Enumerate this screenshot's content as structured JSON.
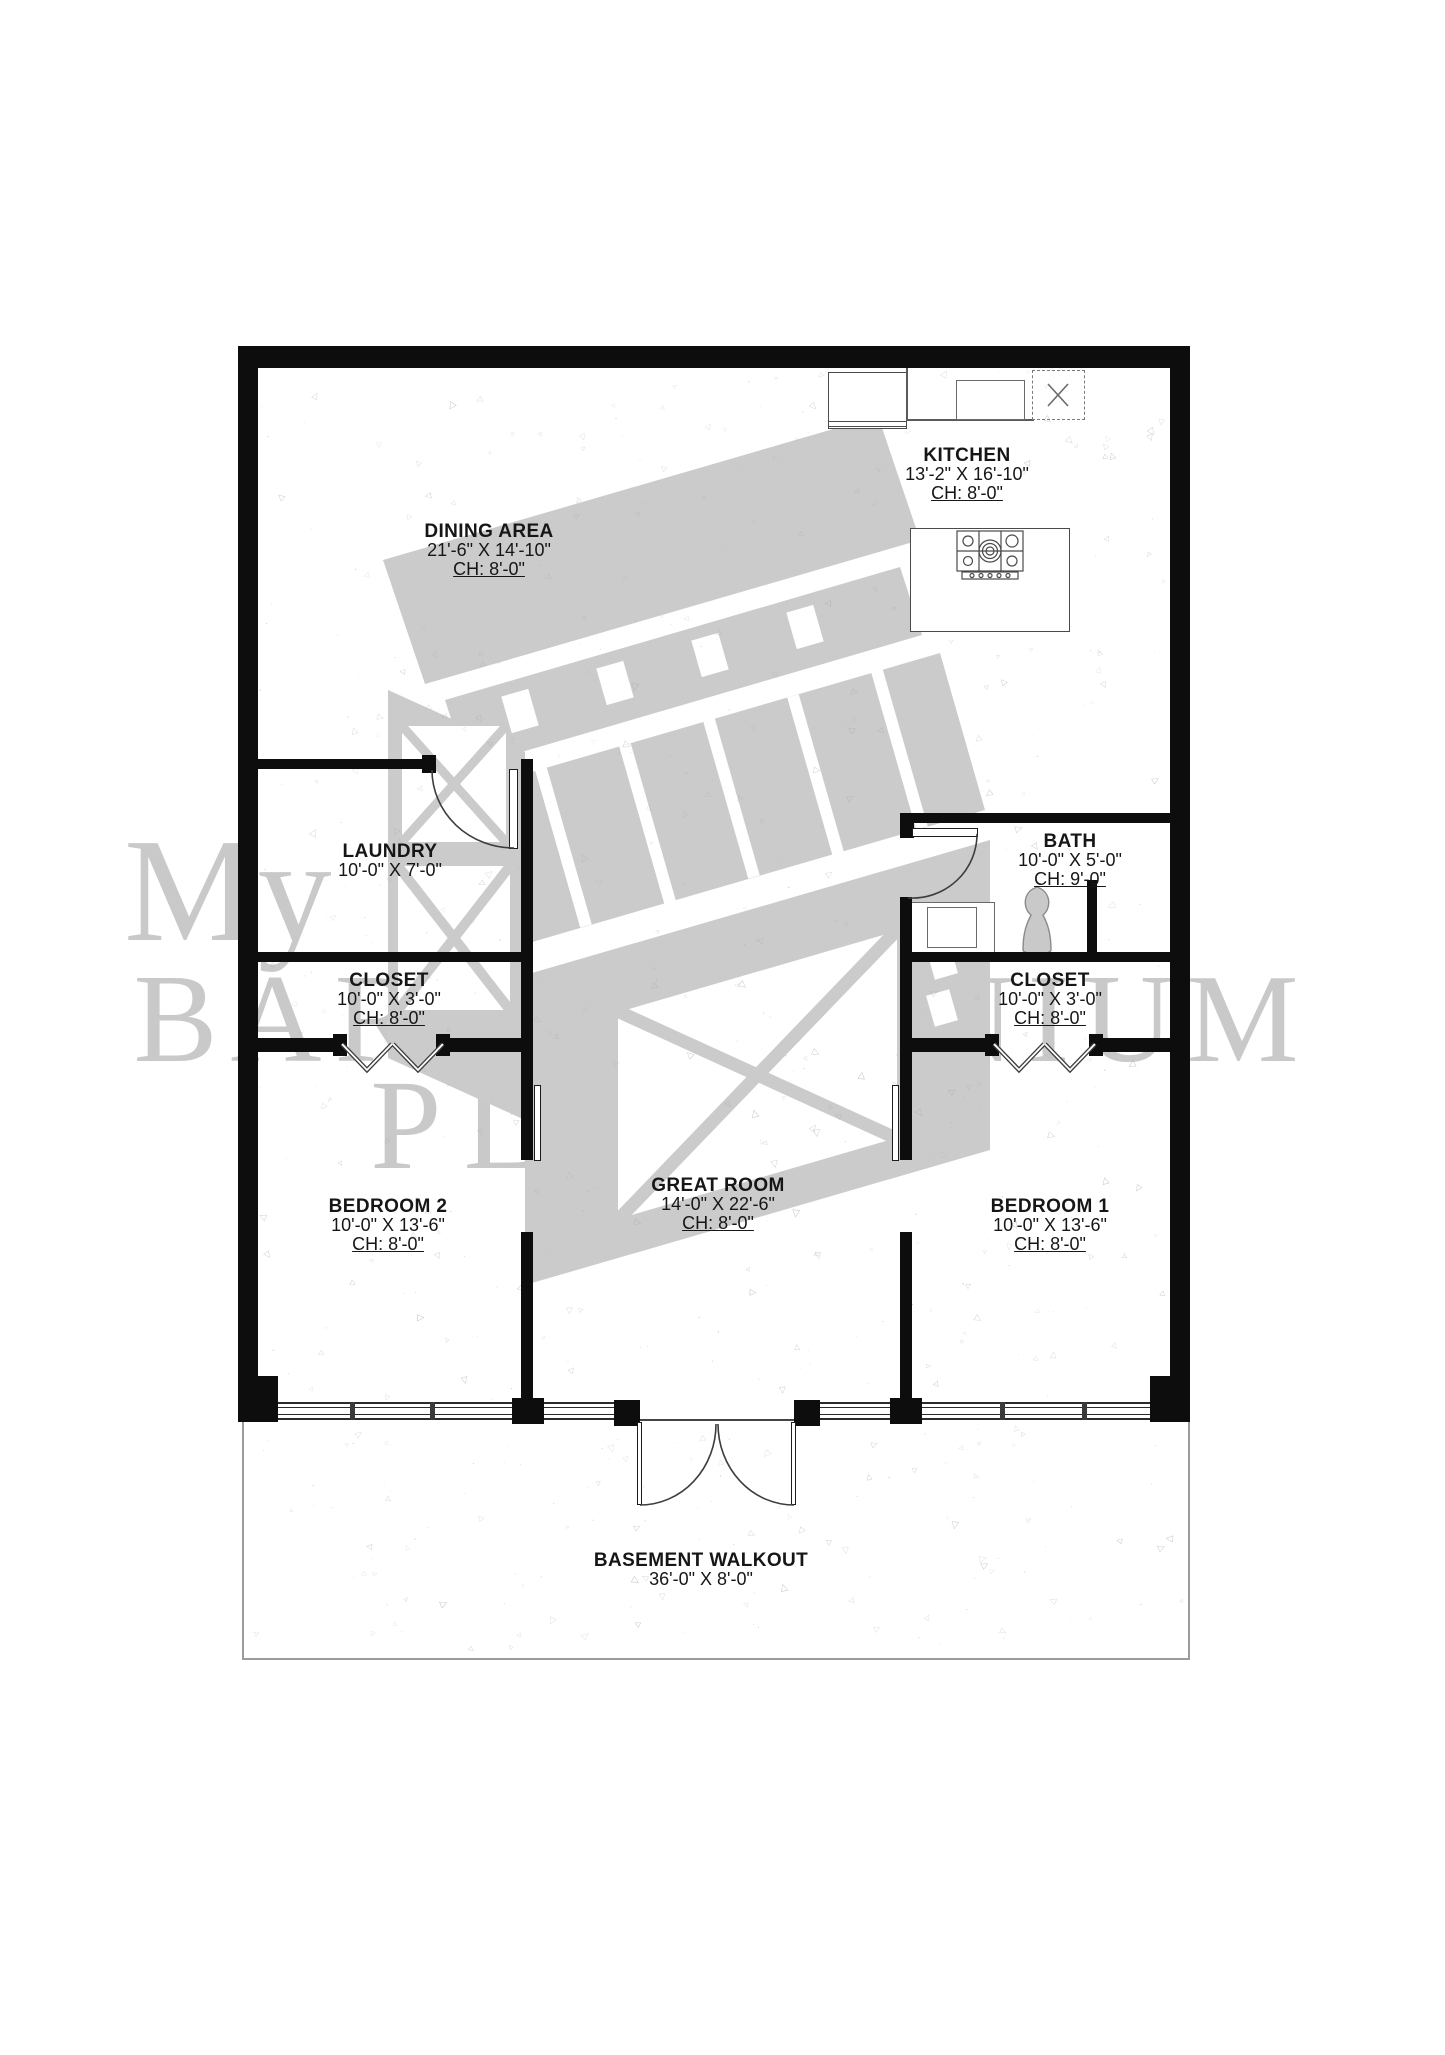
{
  "watermark": {
    "line1": "My",
    "line2": "BARNDOMINIUM",
    "line3": "PLANS",
    "color": "#c9c9c9"
  },
  "rooms": {
    "kitchen": {
      "name": "KITCHEN",
      "dims": "13'-2\" X 16'-10\"",
      "ceiling": "CH: 8'-0\""
    },
    "dining": {
      "name": "DINING AREA",
      "dims": "21'-6\" X 14'-10\"",
      "ceiling": "CH: 8'-0\""
    },
    "laundry": {
      "name": "LAUNDRY",
      "dims": "10'-0\" X 7'-0\""
    },
    "bath": {
      "name": "BATH",
      "dims": "10'-0\" X 5'-0\"",
      "ceiling": "CH: 9'-0\""
    },
    "closet_left": {
      "name": "CLOSET",
      "dims": "10'-0\" X 3'-0\"",
      "ceiling": "CH: 8'-0\""
    },
    "closet_right": {
      "name": "CLOSET",
      "dims": "10'-0\" X 3'-0\"",
      "ceiling": "CH: 8'-0\""
    },
    "bedroom2": {
      "name": "BEDROOM 2",
      "dims": "10'-0\" X 13'-6\"",
      "ceiling": "CH: 8'-0\""
    },
    "great_room": {
      "name": "GREAT ROOM",
      "dims": "14'-0\" X 22'-6\"",
      "ceiling": "CH: 8'-0\""
    },
    "bedroom1": {
      "name": "BEDROOM 1",
      "dims": "10'-0\" X 13'-6\"",
      "ceiling": "CH: 8'-0\""
    },
    "basement_walkout": {
      "name": "BASEMENT WALKOUT",
      "dims": "36'-0\" X 8'-0\""
    }
  },
  "colors": {
    "wall": "#0d0d0d",
    "watermark": "#c9c9c9",
    "linework": "#4a4a4a"
  }
}
